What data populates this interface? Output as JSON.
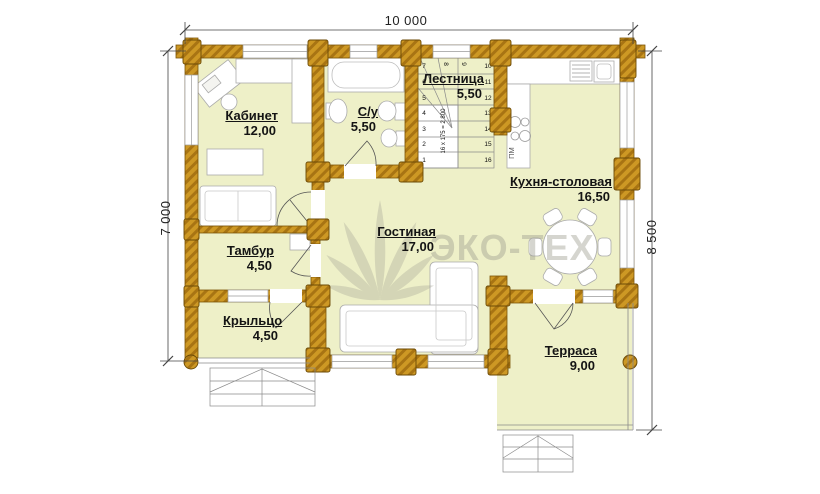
{
  "watermark": {
    "text": "ЭКО-ТЕХ"
  },
  "dimensions": {
    "width_top": "10 000",
    "height_left": "7 000",
    "height_right": "8 500"
  },
  "rooms": {
    "kabinet": {
      "name": "Кабинет",
      "area": "12,00"
    },
    "su": {
      "name": "С/у",
      "area": "5,50"
    },
    "lestnitsa": {
      "name": "Лестница",
      "area": "5,50"
    },
    "kuhnya": {
      "name": "Кухня-столовая",
      "area": "16,50"
    },
    "gostinaya": {
      "name": "Гостиная",
      "area": "17,00"
    },
    "tambur": {
      "name": "Тамбур",
      "area": "4,50"
    },
    "kryltso": {
      "name": "Крыльцо",
      "area": "4,50"
    },
    "terrasa": {
      "name": "Терраса",
      "area": "9,00"
    }
  },
  "stairs": {
    "annotation": "16 х 175 = 2 800",
    "left_numbers": [
      "7",
      "6",
      "5",
      "4",
      "3",
      "2",
      "1"
    ],
    "right_numbers": [
      "10",
      "11",
      "12",
      "13",
      "14",
      "15",
      "16"
    ],
    "winders": [
      "8",
      "9"
    ]
  },
  "labels": {
    "dishwasher": "ПМ"
  },
  "colors": {
    "floor_fill": "#eef0c8",
    "wall_wood": "#cd9824",
    "wall_hatch": "#a87413",
    "watermark_gray": "#9c9c8e",
    "outline": "#7a5408"
  }
}
